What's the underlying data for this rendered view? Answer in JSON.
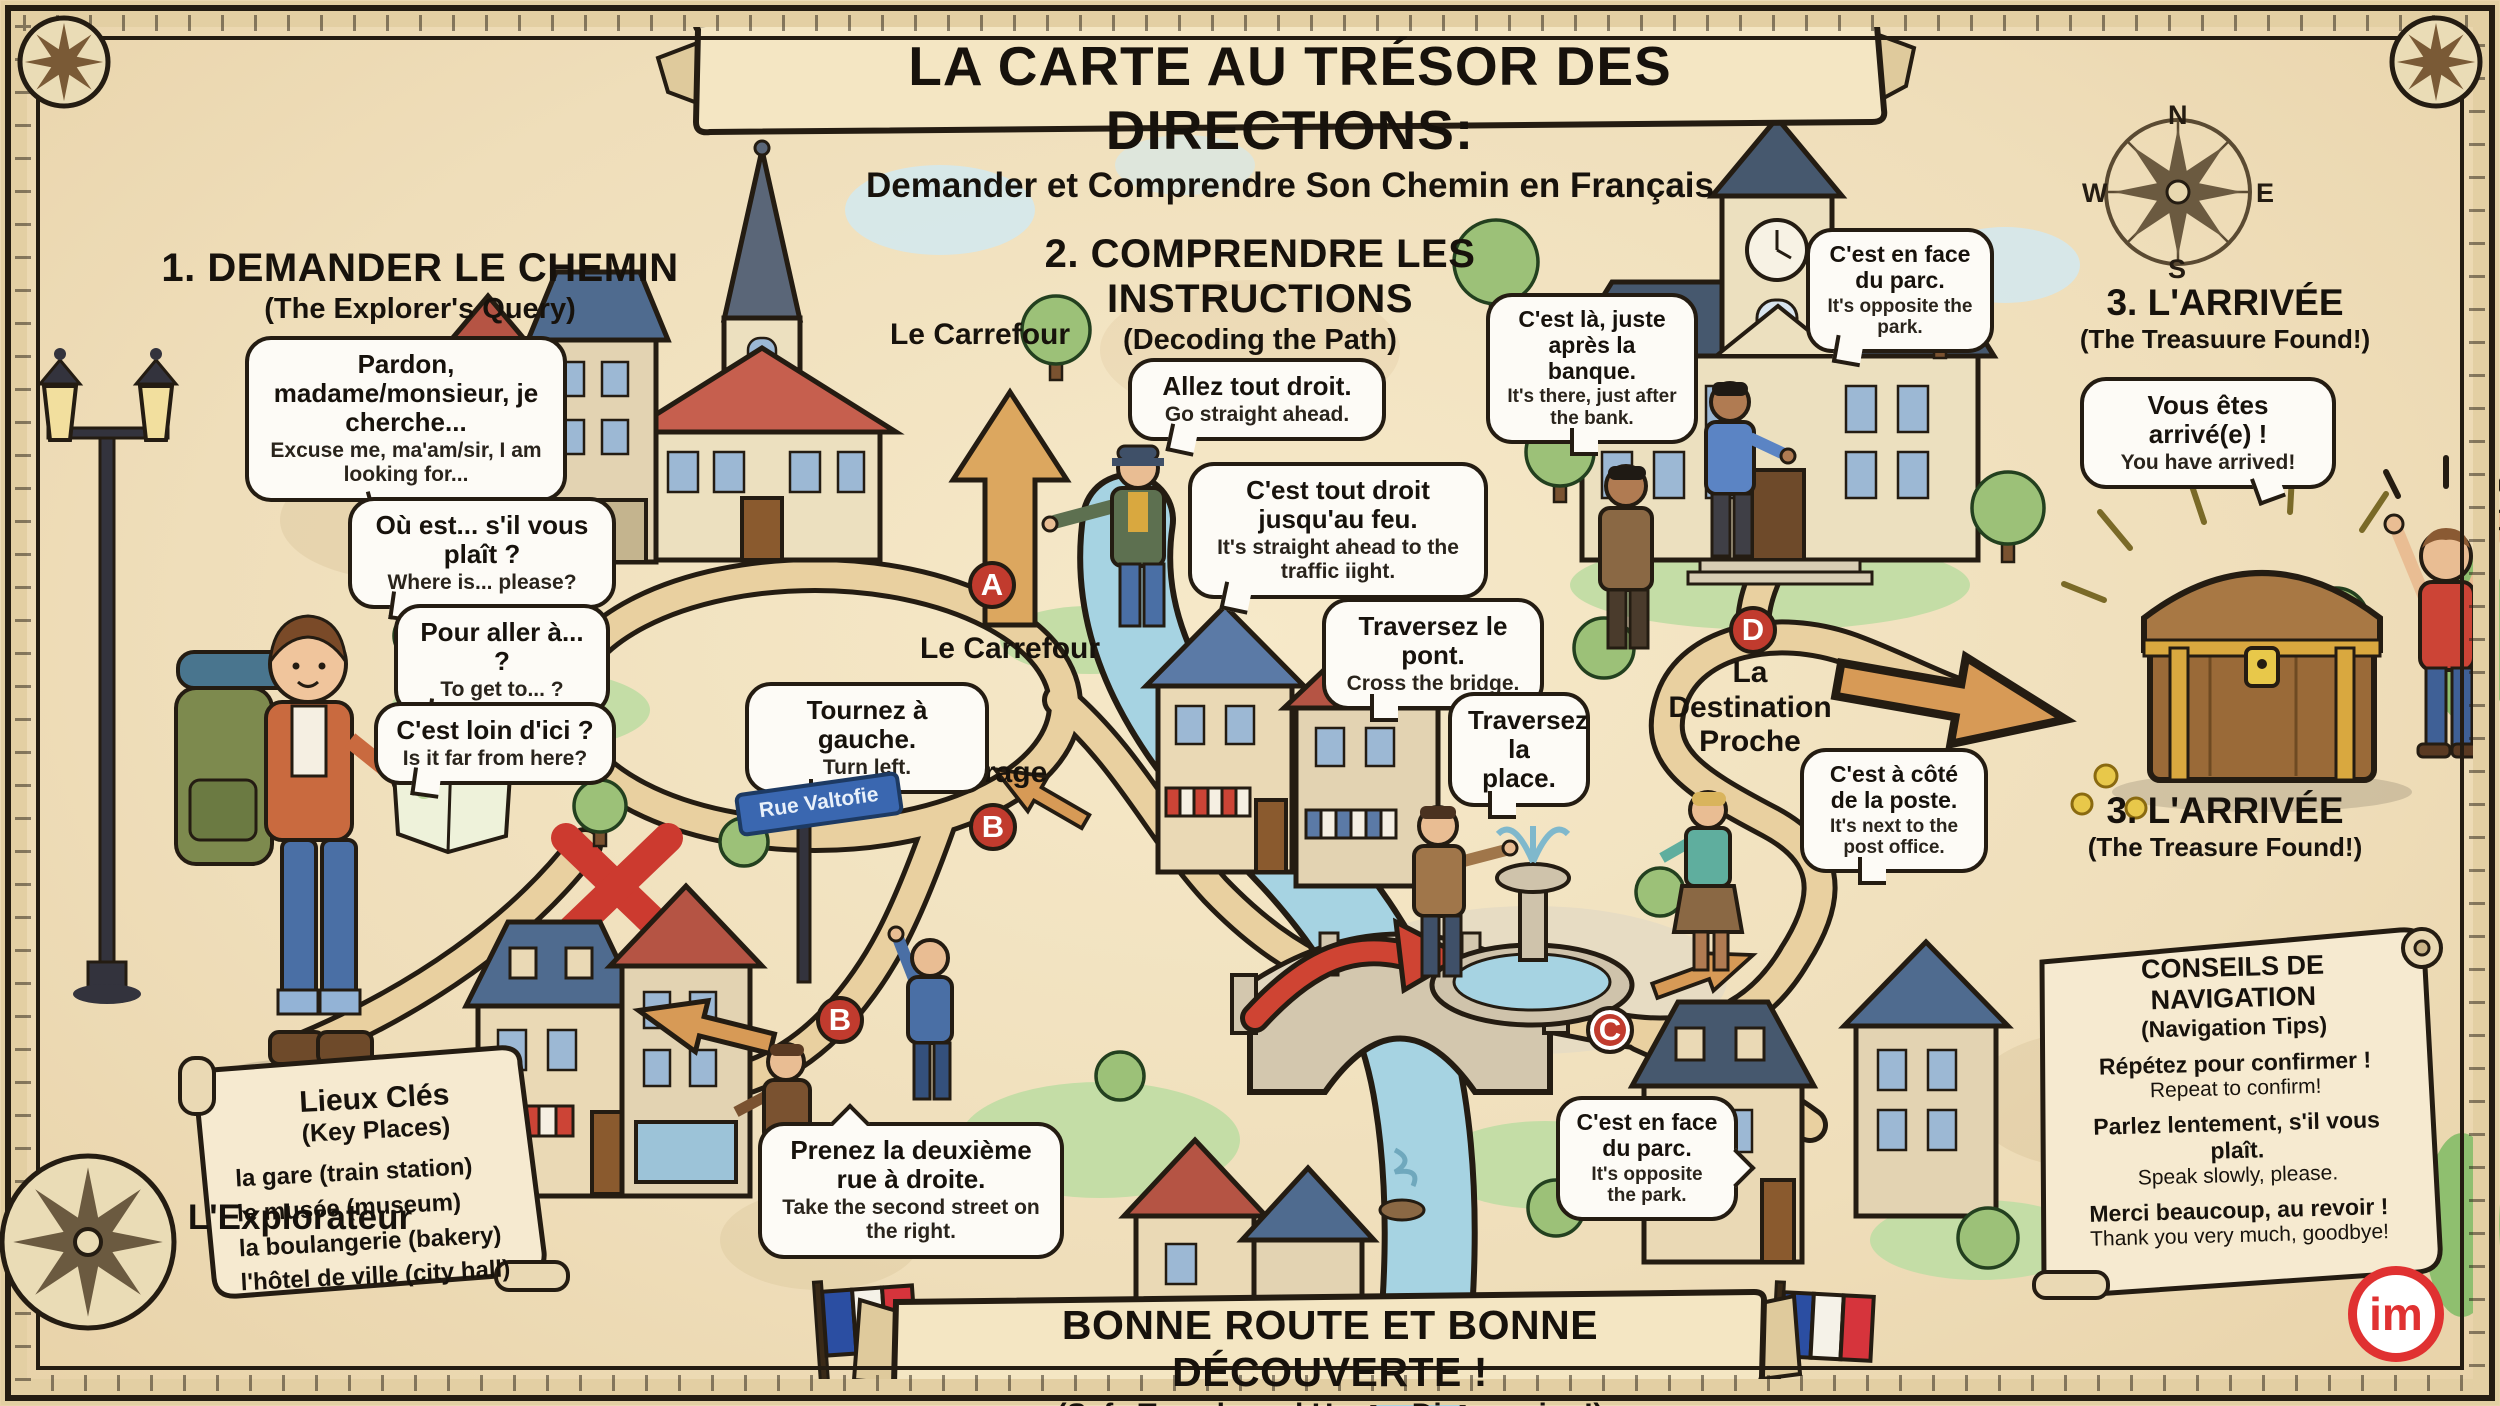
{
  "banner": {
    "title": "LA CARTE AU TRÉSOR DES DIRECTIONS:",
    "subtitle": "Demander et Comprendre Son Chemin en Français"
  },
  "compass": {
    "n": "N",
    "e": "E",
    "s": "S",
    "w": "W"
  },
  "markers": {
    "a": "A",
    "b": "B",
    "c": "C",
    "d": "D"
  },
  "section1": {
    "heading": "1. DEMANDER LE CHEMIN",
    "subheading": "(The Explorer's Query)",
    "figure_label": "L'Explorateur",
    "bubbles": [
      {
        "fr": "Pardon, madame/monsieur, je cherche...",
        "en": "Excuse me, ma'am/sir, I am looking for..."
      },
      {
        "fr": "Où est... s'il vous plaît ?",
        "en": "Where is... please?"
      },
      {
        "fr": "Pour aller à... ?",
        "en": "To get to... ?"
      },
      {
        "fr": "C'est loin d'ici ?",
        "en": "Is it far from here?"
      }
    ]
  },
  "section2": {
    "heading": "2. COMPRENDRE LES INSTRUCTIONS",
    "subheading": "(Decoding the Path)",
    "street_sign": "Rue Valtofie",
    "labels": {
      "carrefour_top": "Le Carrefour",
      "carrefour": "Le Carrefour",
      "virage": "Le Virage",
      "destination": "La Destination Proche"
    },
    "bubbles": [
      {
        "fr": "Allez tout droit.",
        "en": "Go straight ahead."
      },
      {
        "fr": "C'est tout droit jusqu'au feu.",
        "en": "It's straight ahead to the traffic iight."
      },
      {
        "fr": "Tournez à gauche.",
        "en": "Turn left."
      },
      {
        "fr": "Prenez la deuxième rue à droite.",
        "en": "Take the second street on the right."
      },
      {
        "fr": "Traversez le pont.",
        "en": "Cross the bridge."
      },
      {
        "fr": "Traversez la place.",
        "en": ""
      },
      {
        "fr": "C'est là, juste après la banque.",
        "en": "It's there, just after the bank."
      },
      {
        "fr": "C'est en face du parc.",
        "en": "It's opposite the park."
      },
      {
        "fr": "C'est à côté de la poste.",
        "en": "It's next to the post office."
      },
      {
        "fr": "C'est en face du parc.",
        "en": "It's opposite the park."
      }
    ]
  },
  "section3": {
    "heading": "3. L'ARRIVÉE",
    "subheading": "(The Treasuure Found!)",
    "bubble": {
      "fr": "Vous êtes arrivé(e) !",
      "en": "You have arrived!"
    },
    "footer_label": "3. L'ARRIVÉE",
    "footer_sublabel": "(The Treasure Found!)"
  },
  "key_places": {
    "title": "Lieux Clés",
    "subtitle": "(Key Places)",
    "items": [
      "la gare (train station)",
      "le musée (museum)",
      "la boulangerie (bakery)",
      "l'hôtel de ville (city hall)"
    ]
  },
  "nav_tips": {
    "title": "CONSEILS DE NAVIGATION",
    "subtitle": "(Navigation Tips)",
    "items": [
      {
        "fr": "Répétez pour confirmer !",
        "en": "Repeat to confirm!"
      },
      {
        "fr": "Parlez lentement, s'il vous plaît.",
        "en": "Speak slowly, please."
      },
      {
        "fr": "Merci beaucoup, au revoir !",
        "en": "Thank you very much, goodbye!"
      }
    ]
  },
  "footer_banner": {
    "fr": "BONNE ROUTE ET BONNE DÉCOUVERTE !",
    "en": "(Safe Travels and Happy Discovering!)"
  },
  "logo": "im",
  "colors": {
    "parchment": "#f2e3c2",
    "ink": "#241c12",
    "marker_red": "#c13b2e",
    "path_tan": "#e9d0a0",
    "river_blue": "#a6d3e2",
    "arrow_red": "#cf4433",
    "sign_blue": "#3a67b0",
    "flag_blue": "#2b4ea2",
    "flag_red": "#d6343c",
    "logo_red": "#e03131"
  }
}
